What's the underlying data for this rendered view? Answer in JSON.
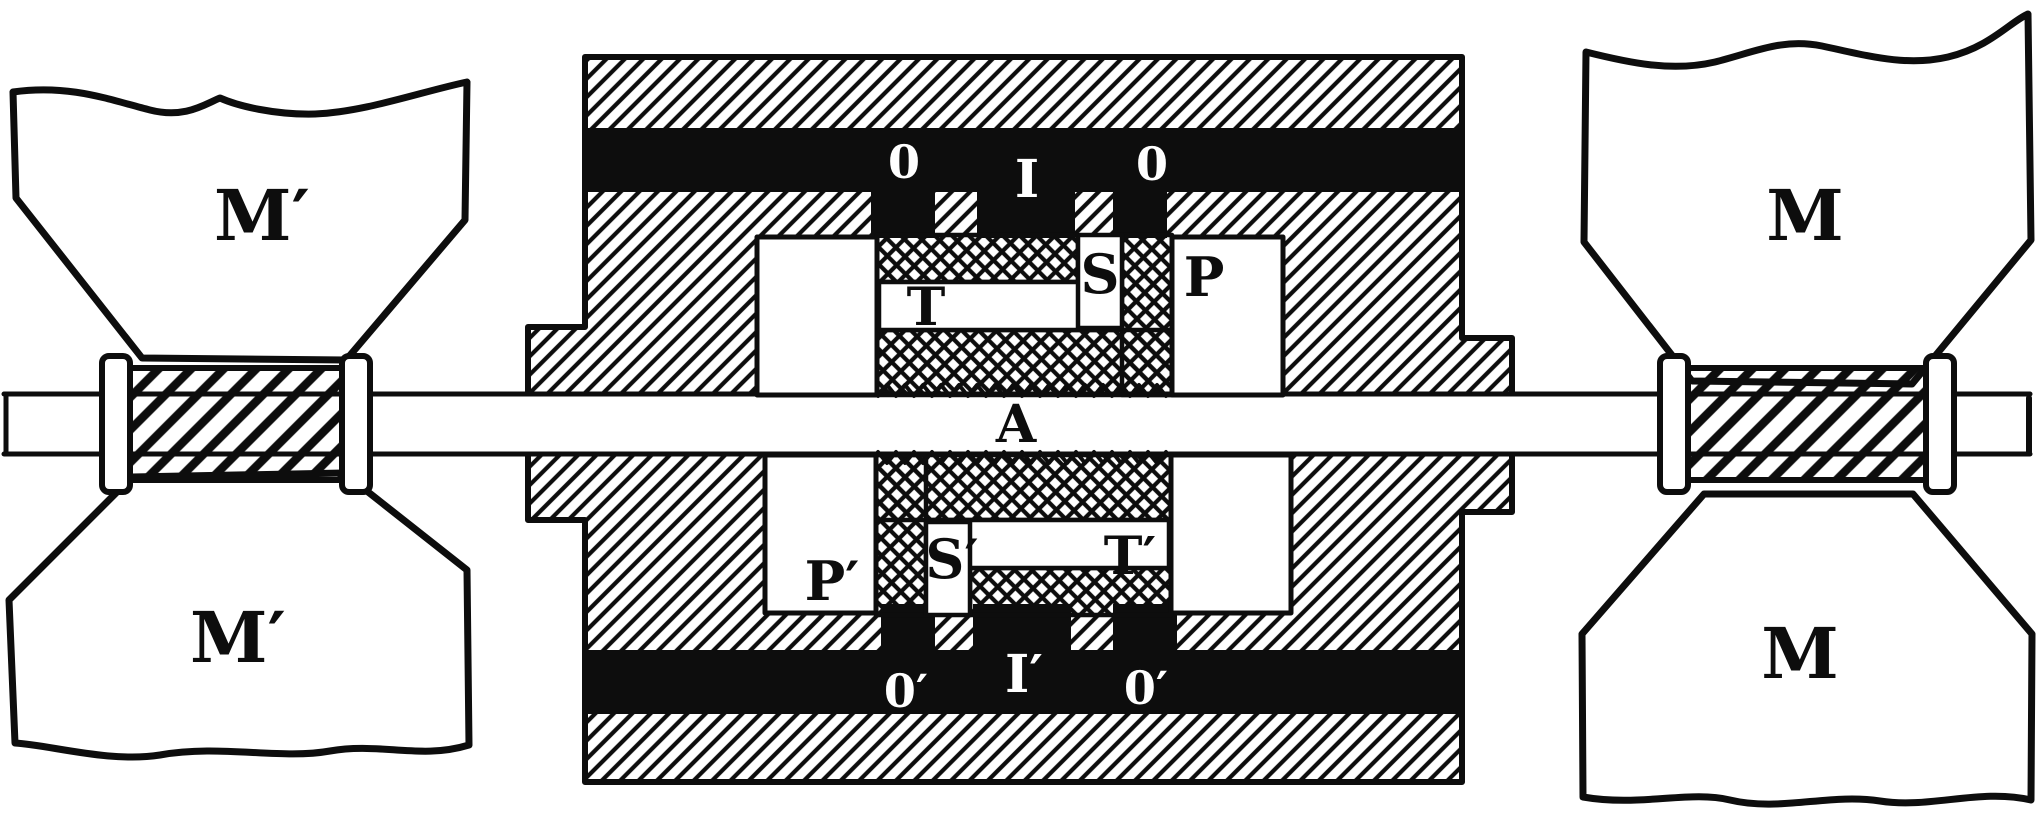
{
  "figure": {
    "colors": {
      "ink": "#0d0d0d",
      "paper": "#ffffff"
    },
    "labels": {
      "m_top_left": "M′",
      "m_bottom_left": "M′",
      "m_top_right": "M",
      "m_bottom_right": "M",
      "o_top_left": "0",
      "i_top": "I",
      "o_top_right": "0",
      "s_top": "S",
      "t_top": "T",
      "p_top": "P",
      "a_shaft": "A",
      "p_bottom": "P′",
      "s_bottom": "S′",
      "t_bottom": "T′",
      "o_bottom_left": "0′",
      "i_bottom": "I′",
      "o_bottom_right": "0′"
    }
  }
}
